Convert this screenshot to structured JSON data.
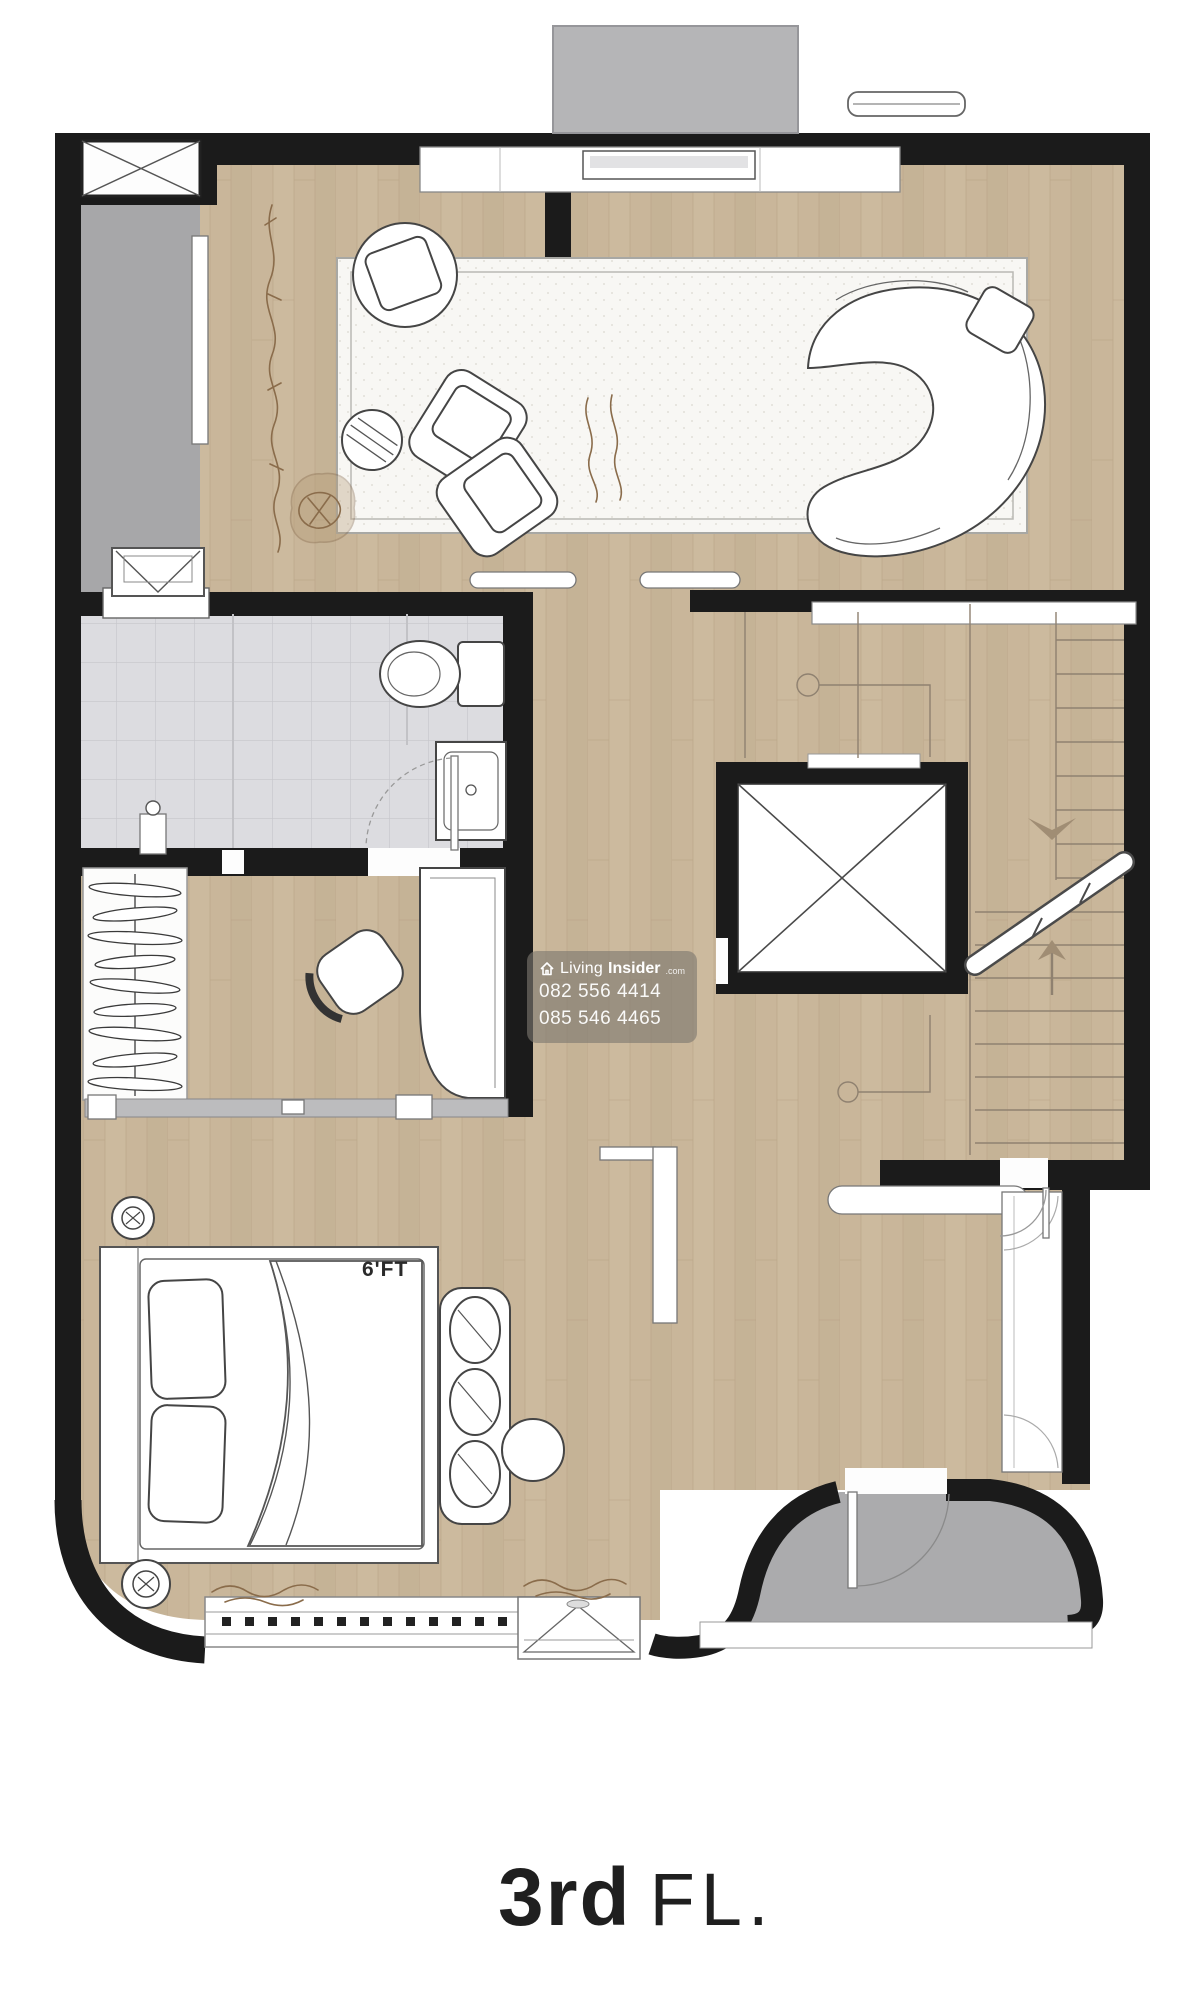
{
  "floor_label": {
    "number": "3rd",
    "suffix": "FL."
  },
  "bedroom": {
    "bed_size_label": "6'FT"
  },
  "watermark": {
    "brand_prefix": "Living",
    "brand_suffix": "Insider",
    "brand_tld": ".com",
    "phone_line1": "082 556 4414",
    "phone_line2": "085 546 4465"
  },
  "colors": {
    "wall": "#1b1b1b",
    "wood_floor": "#c9b69a",
    "wood_line": "#b7a284",
    "balcony_gray": "#a7a7a9",
    "terrace_gray": "#ababad",
    "bathroom_tile": "#dcdce0",
    "tile_line": "#c6c6cb",
    "canopy_gray": "#b5b5b7",
    "plant_brown": "#8a6c4b",
    "watermark_bg": "rgba(124,119,112,0.62)",
    "watermark_text": "#ffffff",
    "label_color": "#1f1f1f"
  }
}
